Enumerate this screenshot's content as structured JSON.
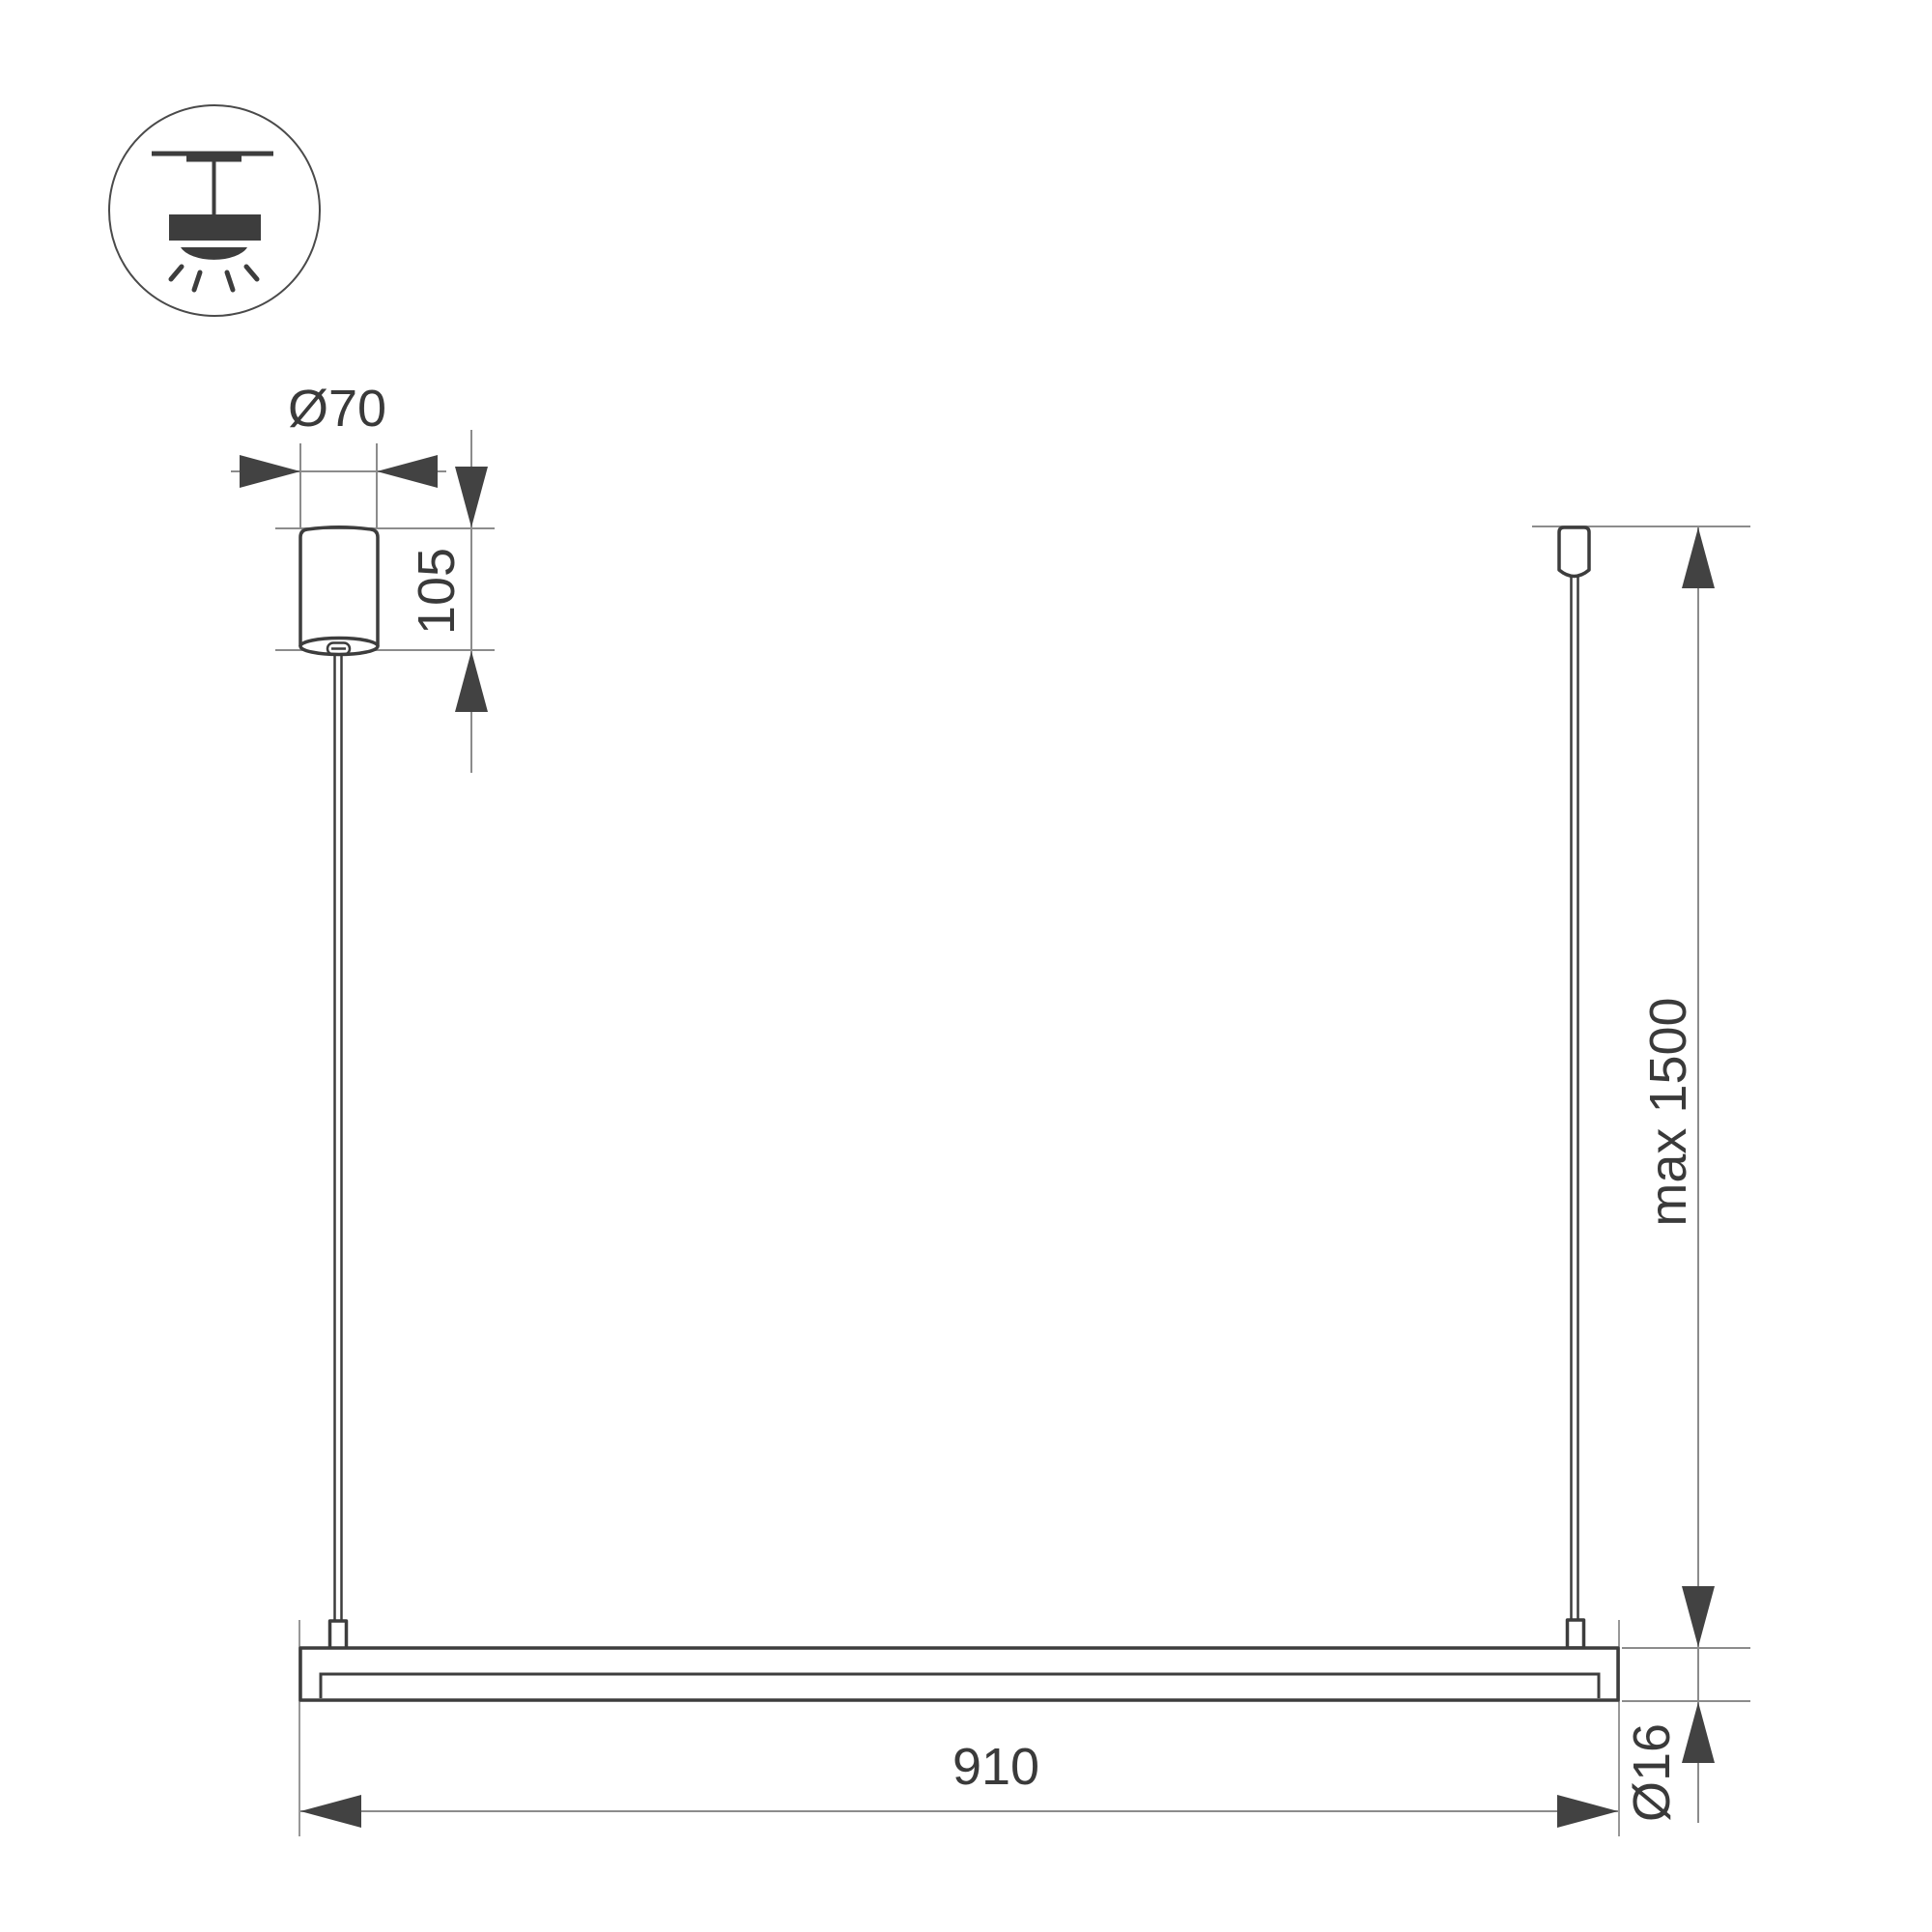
{
  "icons": {
    "badge": "pendant-ceiling-light-icon"
  },
  "labels": {
    "canopy_diameter": "Ø70",
    "canopy_height": "105",
    "max_suspension": "max 1500",
    "bar_length": "910",
    "bar_diameter": "Ø16"
  },
  "colors": {
    "dark": "#3d3d3d",
    "thin": "#8c8c8c",
    "arrow": "#424242",
    "text": "#3a3a3a",
    "bg": "#ffffff"
  }
}
